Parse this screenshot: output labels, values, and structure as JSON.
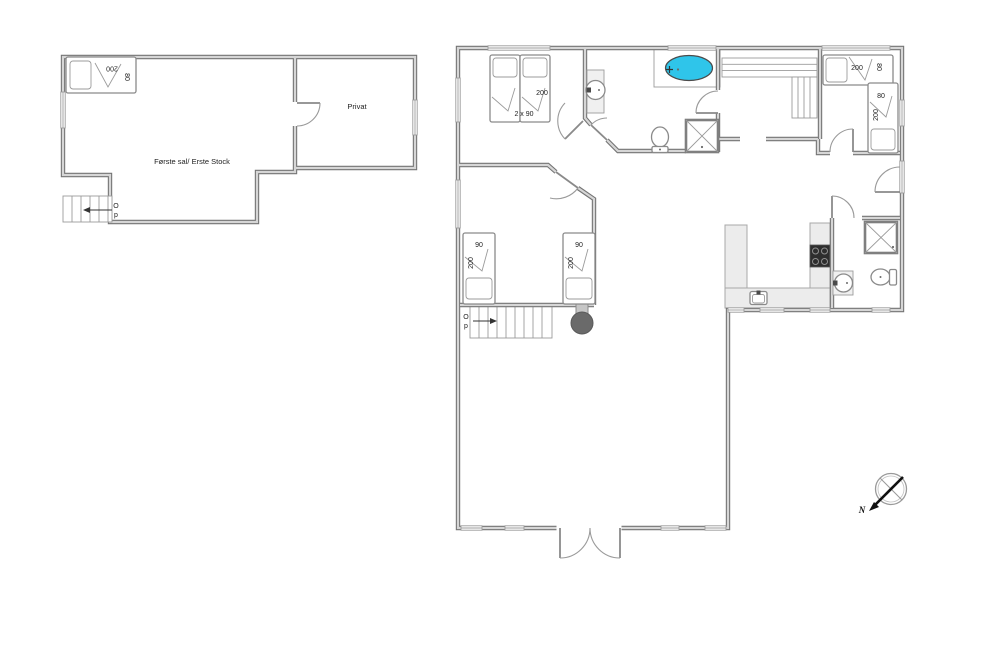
{
  "colors": {
    "wall_edge": "#747474",
    "wall_core": "#d6d6d6",
    "window": "#9b9b9b",
    "tub_fill": "#2fc5ea",
    "stove_fill": "#6a6a6a",
    "cooktop_fill": "#2e2e2e",
    "counter_fill": "#ececec",
    "furniture_stroke": "#8a8a8a",
    "label_text": "#222222",
    "compass_arrow": "#111111"
  },
  "first_floor": {
    "room_label": "Første sal/ Erste Stock",
    "privat_label": "Privat",
    "bed": {
      "length_label": "200",
      "width_label": "80"
    },
    "stairs": {
      "up_letter_1": "O",
      "up_letter_2": "p"
    }
  },
  "ground_floor": {
    "double_bed": {
      "size_label": "2 x 90",
      "length_label": "200"
    },
    "single_bed_left": {
      "width_label": "90",
      "length_label": "200"
    },
    "single_bed_right": {
      "width_label": "90",
      "length_label": "200"
    },
    "right_bedroom_bed_top": {
      "length_label": "200",
      "width_label": "80"
    },
    "right_bedroom_bed_side": {
      "width_label": "80",
      "length_label": "200"
    },
    "stairs": {
      "up_letter_1": "O",
      "up_letter_2": "p"
    }
  },
  "compass": {
    "north_label": "N"
  },
  "symbols": {
    "whirlpool": "oval-bathtub",
    "shower": "square-with-x",
    "toilet": "toilet",
    "washbasin": "circle-basin",
    "wood_stove": "round-stove",
    "cooktop": "four-burner-cooktop",
    "sink": "kitchen-sink"
  }
}
